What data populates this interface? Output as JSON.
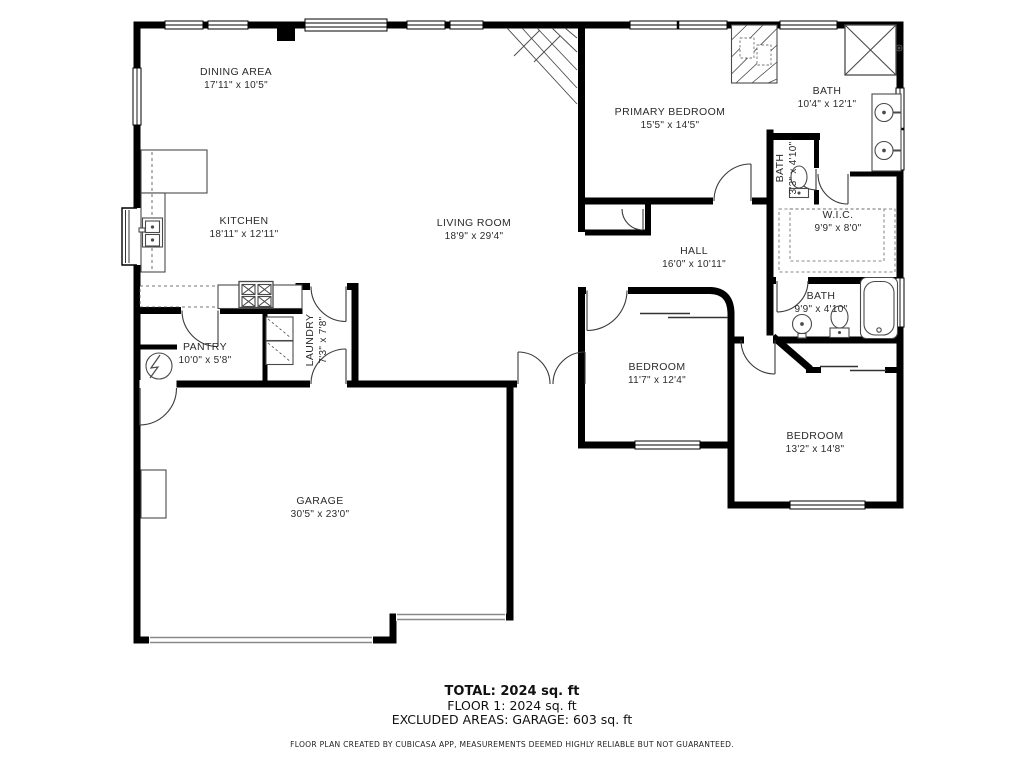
{
  "plan": {
    "rooms": [
      {
        "id": "dining-area",
        "name": "DINING AREA",
        "dims": "17'11\" x 10'5\"",
        "cx": 236,
        "cy": 79,
        "rot": false
      },
      {
        "id": "kitchen",
        "name": "KITCHEN",
        "dims": "18'11\" x 12'11\"",
        "cx": 244,
        "cy": 228,
        "rot": false
      },
      {
        "id": "living-room",
        "name": "LIVING ROOM",
        "dims": "18'9\" x 29'4\"",
        "cx": 474,
        "cy": 230,
        "rot": false
      },
      {
        "id": "primary-bedroom",
        "name": "PRIMARY BEDROOM",
        "dims": "15'5\" x 14'5\"",
        "cx": 670,
        "cy": 119,
        "rot": false
      },
      {
        "id": "primary-bath",
        "name": "BATH",
        "dims": "10'4\" x 12'1\"",
        "cx": 827,
        "cy": 98,
        "rot": false
      },
      {
        "id": "small-bath",
        "name": "BATH",
        "dims": "3'3\" x 4'10\"",
        "cx": 787,
        "cy": 168,
        "rot": true
      },
      {
        "id": "walk-in-closet",
        "name": "W.I.C.",
        "dims": "9'9\" x 8'0\"",
        "cx": 838,
        "cy": 222,
        "rot": false
      },
      {
        "id": "hall",
        "name": "HALL",
        "dims": "16'0\" x 10'11\"",
        "cx": 694,
        "cy": 258,
        "rot": false
      },
      {
        "id": "hall-bath",
        "name": "BATH",
        "dims": "9'9\" x 4'10\"",
        "cx": 821,
        "cy": 303,
        "rot": false
      },
      {
        "id": "bedroom-1",
        "name": "BEDROOM",
        "dims": "11'7\" x 12'4\"",
        "cx": 657,
        "cy": 374,
        "rot": false
      },
      {
        "id": "bedroom-2",
        "name": "BEDROOM",
        "dims": "13'2\" x 14'8\"",
        "cx": 815,
        "cy": 443,
        "rot": false
      },
      {
        "id": "laundry",
        "name": "LAUNDRY",
        "dims": "7'3\" x 7'8\"",
        "cx": 317,
        "cy": 340,
        "rot": true
      },
      {
        "id": "pantry",
        "name": "PANTRY",
        "dims": "10'0\" x 5'8\"",
        "cx": 205,
        "cy": 354,
        "rot": false
      },
      {
        "id": "garage",
        "name": "GARAGE",
        "dims": "30'5\" x 23'0\"",
        "cx": 320,
        "cy": 508,
        "rot": false
      }
    ]
  },
  "footer": {
    "total": "TOTAL: 2024 sq. ft",
    "floor": "FLOOR 1: 2024 sq. ft",
    "excluded": "EXCLUDED AREAS: GARAGE: 603 sq. ft",
    "disclaimer": "FLOOR PLAN CREATED BY CUBICASA APP, MEASUREMENTS DEEMED HIGHLY RELIABLE BUT NOT GUARANTEED."
  },
  "colors": {
    "wall": "#000000",
    "fixture": "#4a4a4a",
    "garage_door": "#8a8a8a",
    "label": "#2b2b2b"
  }
}
